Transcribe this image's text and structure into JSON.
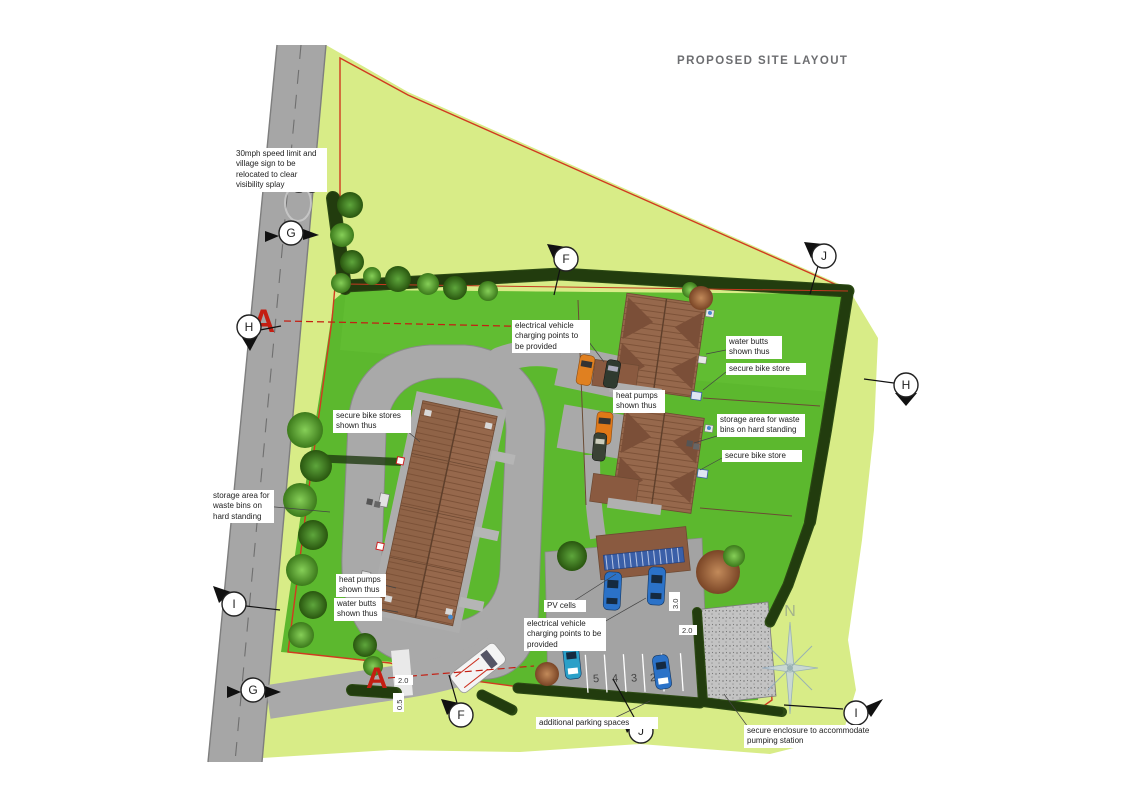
{
  "title": "PROPOSED SITE LAYOUT",
  "road": {
    "speed_marking": "30"
  },
  "compass": {
    "north": "N"
  },
  "section": {
    "label": "A"
  },
  "markers": {
    "g_top": "G",
    "h_left": "H",
    "f_top": "F",
    "j_top": "J",
    "h_right": "H",
    "i_left": "I",
    "g_bottom": "G",
    "f_bottom": "F",
    "j_bottom": "J",
    "i_right": "I"
  },
  "parking": {
    "s5": "5",
    "s4": "4",
    "s3": "3",
    "s2": "2"
  },
  "dimensions": {
    "entrance_width": "2.0",
    "entrance_verge": "0.5",
    "parking_width": "2.0",
    "parking_depth": "3.0"
  },
  "annotations": {
    "speed_sign": "30mph speed limit and village sign to be relocated to clear visibility splay",
    "ev_top": "electrical vehicle charging points to be provided",
    "water_butts_right": "water butts shown thus",
    "bike_store_right_upper": "secure bike store",
    "heat_pumps_right": "heat pumps shown thus",
    "storage_right": "storage area for waste bins on hard standing",
    "bike_store_right_lower": "secure bike store",
    "bike_stores_left": "secure bike stores shown thus",
    "storage_left": "storage area for waste bins on hard standing",
    "heat_pumps_left": "heat pumps shown thus",
    "water_butts_left": "water butts shown thus",
    "pv_cells": "PV cells",
    "ev_bottom": "electrical vehicle charging points to be provided",
    "additional_parking": "additional parking spaces",
    "pumping_station": "secure enclosure to accommodate pumping station"
  },
  "colors": {
    "site_boundary_red": "#d13a20",
    "field_green": "#d8ec87",
    "grass_green": "#5cb82e",
    "hedge_green": "#2c4a13",
    "road_grey": "#a6a6a6",
    "roof_brown": "#96684c",
    "pv_blue": "#3a5fa8",
    "title_grey": "#6d6e71",
    "section_red": "#c41e12",
    "car_orange": "#e07818",
    "car_blue": "#2b72c8"
  }
}
